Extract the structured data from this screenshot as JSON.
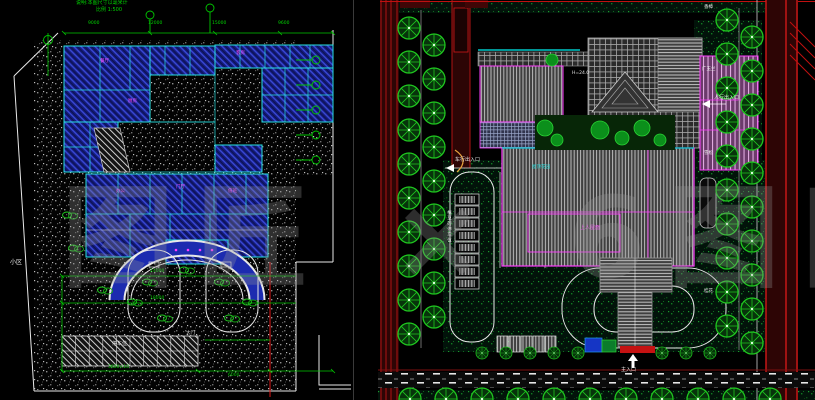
{
  "watermark": {
    "text": "图匠 × 6图网"
  },
  "palette": {
    "building_blue": "#141b7a",
    "wall_cyan": "#27e0e0",
    "dim_green": "#00d400",
    "outline_magenta": "#ff3dff",
    "road_red": "#d01818",
    "dark_red_road": "#2d0505",
    "tree_green": "#1fc61f",
    "hatch_gray": "#b9b9b9"
  },
  "left_plan": {
    "note1": "说明:本图尺寸以毫米计",
    "note2": "比例 1:500",
    "top_dims": [
      "9000",
      "12000",
      "15000",
      "9600"
    ],
    "side_label": "小区",
    "mid_dims": [
      "24000",
      "18000"
    ],
    "parking_label": "停车位",
    "bottom_dims": [
      "3600×10",
      "6000"
    ],
    "room_labels": [
      "门厅",
      "餐厅",
      "厨房",
      "客房",
      "办公",
      "值班"
    ],
    "gate_label": "大门"
  },
  "right_plan": {
    "parking_label": "植草砖停车位",
    "car_entry_label": "车行出入口",
    "ped_entry_label": "人行出入口",
    "main_entry_label": "主入口",
    "height_note": "H=24.0",
    "roof_label": "上人屋面",
    "garden_label": "屋顶花园",
    "tree_labels": [
      "香樟",
      "广玉兰",
      "雪松",
      "桂花"
    ]
  }
}
